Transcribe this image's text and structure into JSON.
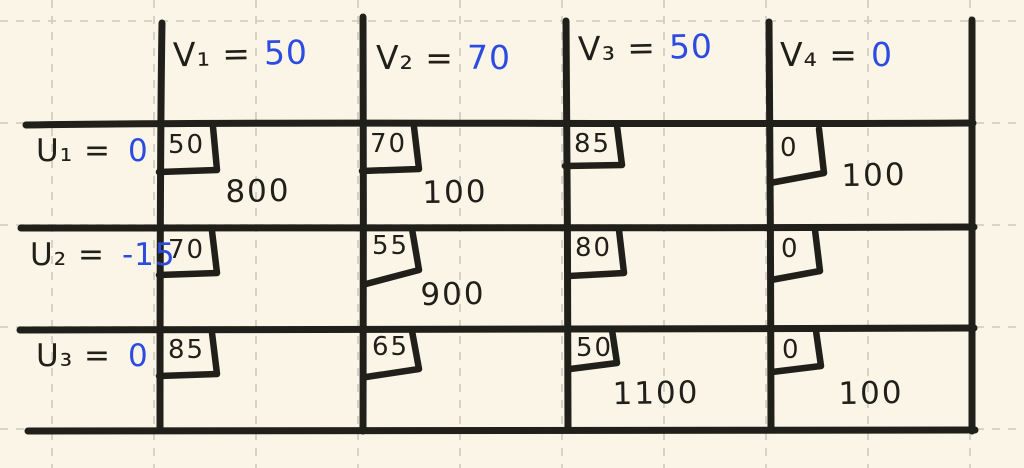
{
  "diagram_title": "transportation-tableau",
  "colors": {
    "background": "#faf5e7",
    "grid": "#d2cfc5",
    "ink": "#211f1a",
    "value_blue": "#2c4be0"
  },
  "table": {
    "column_headers": [
      {
        "label": "V₁ =",
        "value": "50"
      },
      {
        "label": "V₂ =",
        "value": "70"
      },
      {
        "label": "V₃ =",
        "value": "50"
      },
      {
        "label": "V₄ =",
        "value": "0"
      }
    ],
    "rows": [
      {
        "label": "U₁ =",
        "value": "0",
        "cells": [
          {
            "cost": "50",
            "allocation": "800"
          },
          {
            "cost": "70",
            "allocation": "100"
          },
          {
            "cost": "85",
            "allocation": ""
          },
          {
            "cost": "0",
            "allocation": "100"
          }
        ]
      },
      {
        "label": "U₂ =",
        "value": "-15",
        "cells": [
          {
            "cost": "70",
            "allocation": ""
          },
          {
            "cost": "55",
            "allocation": "900"
          },
          {
            "cost": "80",
            "allocation": ""
          },
          {
            "cost": "0",
            "allocation": ""
          }
        ]
      },
      {
        "label": "U₃ =",
        "value": "0",
        "cells": [
          {
            "cost": "85",
            "allocation": ""
          },
          {
            "cost": "65",
            "allocation": ""
          },
          {
            "cost": "50",
            "allocation": "1100"
          },
          {
            "cost": "0",
            "allocation": "100"
          }
        ]
      }
    ]
  }
}
